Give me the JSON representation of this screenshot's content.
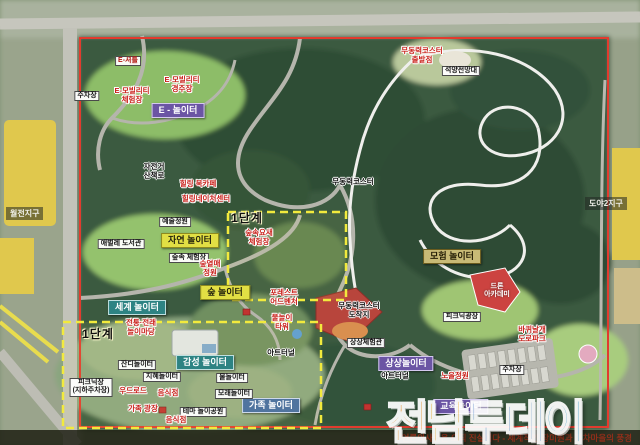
{
  "colors": {
    "boundary_red": "#e23b2e",
    "phase_dash_yellow": "#f2ea3d",
    "zone_purple": "#6b55a4",
    "zone_teal": "#2d8383",
    "zone_yellow": "#e2df44",
    "zone_khaki": "#c8ba76",
    "zone_blue": "#50749f",
    "watermark_orange": "#f08c1e",
    "watermark_blue": "#2f74c0"
  },
  "watermark": {
    "chars": [
      "전",
      "남",
      "투",
      "데",
      "이"
    ]
  },
  "bottom_bar": {
    "text": "'언론의사명은 오직 진실이다 - 세계적인 장미원과 기차마을의 풍경"
  },
  "districts": {
    "left": "월전지구",
    "right": "도야2지구"
  },
  "phase": {
    "label": "1단계"
  },
  "zones": {
    "e": "E - 놀이터",
    "nature": "자연 놀이터",
    "forest": "숲 놀이터",
    "world": "세계 놀이터",
    "emotion": "감성 놀이터",
    "adventure": "모험 놀이터",
    "family": "가족 놀이터",
    "imagination": "상상놀이터",
    "education": "교육놀이터"
  },
  "facilities": {
    "parking_west": "주차장",
    "e_shuttle": "E-셔틀",
    "e_mobility_experience": "E-모빌리티\n체험장",
    "e_mobility_race": "E-모빌리티\n경주장",
    "art_garden": "예술정원",
    "caterpillar_library": "애벌레 도서관",
    "forest_experience": "숲속 체험장",
    "forest_fruit_garden": "숲열매\n정원",
    "forest_fortress": "숲속요새\n체험장",
    "bike_trail": "자전거\n산책로",
    "healing_book_cafe": "힐링 북카페",
    "healing_nature_center": "힐링네이처센터",
    "coaster_track": "무동력코스터",
    "coaster_start": "무동력코스터\n출발점",
    "coaster_finish": "무동력코스터\n도착지",
    "sunset_observatory": "석양전망대",
    "drone_academy": "드론\n아카데미",
    "picnic_square": "피크닉광장",
    "wheel_road_park": "바퀴날개\n도로파크",
    "parking_east": "주차장",
    "sunset_garden": "노을정원",
    "imagination_hall": "상상체험관",
    "art_tunnel": "아트터널",
    "forest_adventure": "포레스트\n어드벤처",
    "water_tower": "물놀이\n타워",
    "traditional_play": "전통·전래\n놀이마당",
    "grass_playground": "잔디놀이터",
    "wisdom_playground": "지혜놀이터",
    "picnic_underground": "피크닉장\n(지하주차장)",
    "wood_road": "우드로드",
    "restaurant": "음식점",
    "family_square": "가족 광장",
    "water_play": "물놀이터",
    "sand_play": "모래놀이터",
    "theme_park": "테마 놀이공원"
  }
}
